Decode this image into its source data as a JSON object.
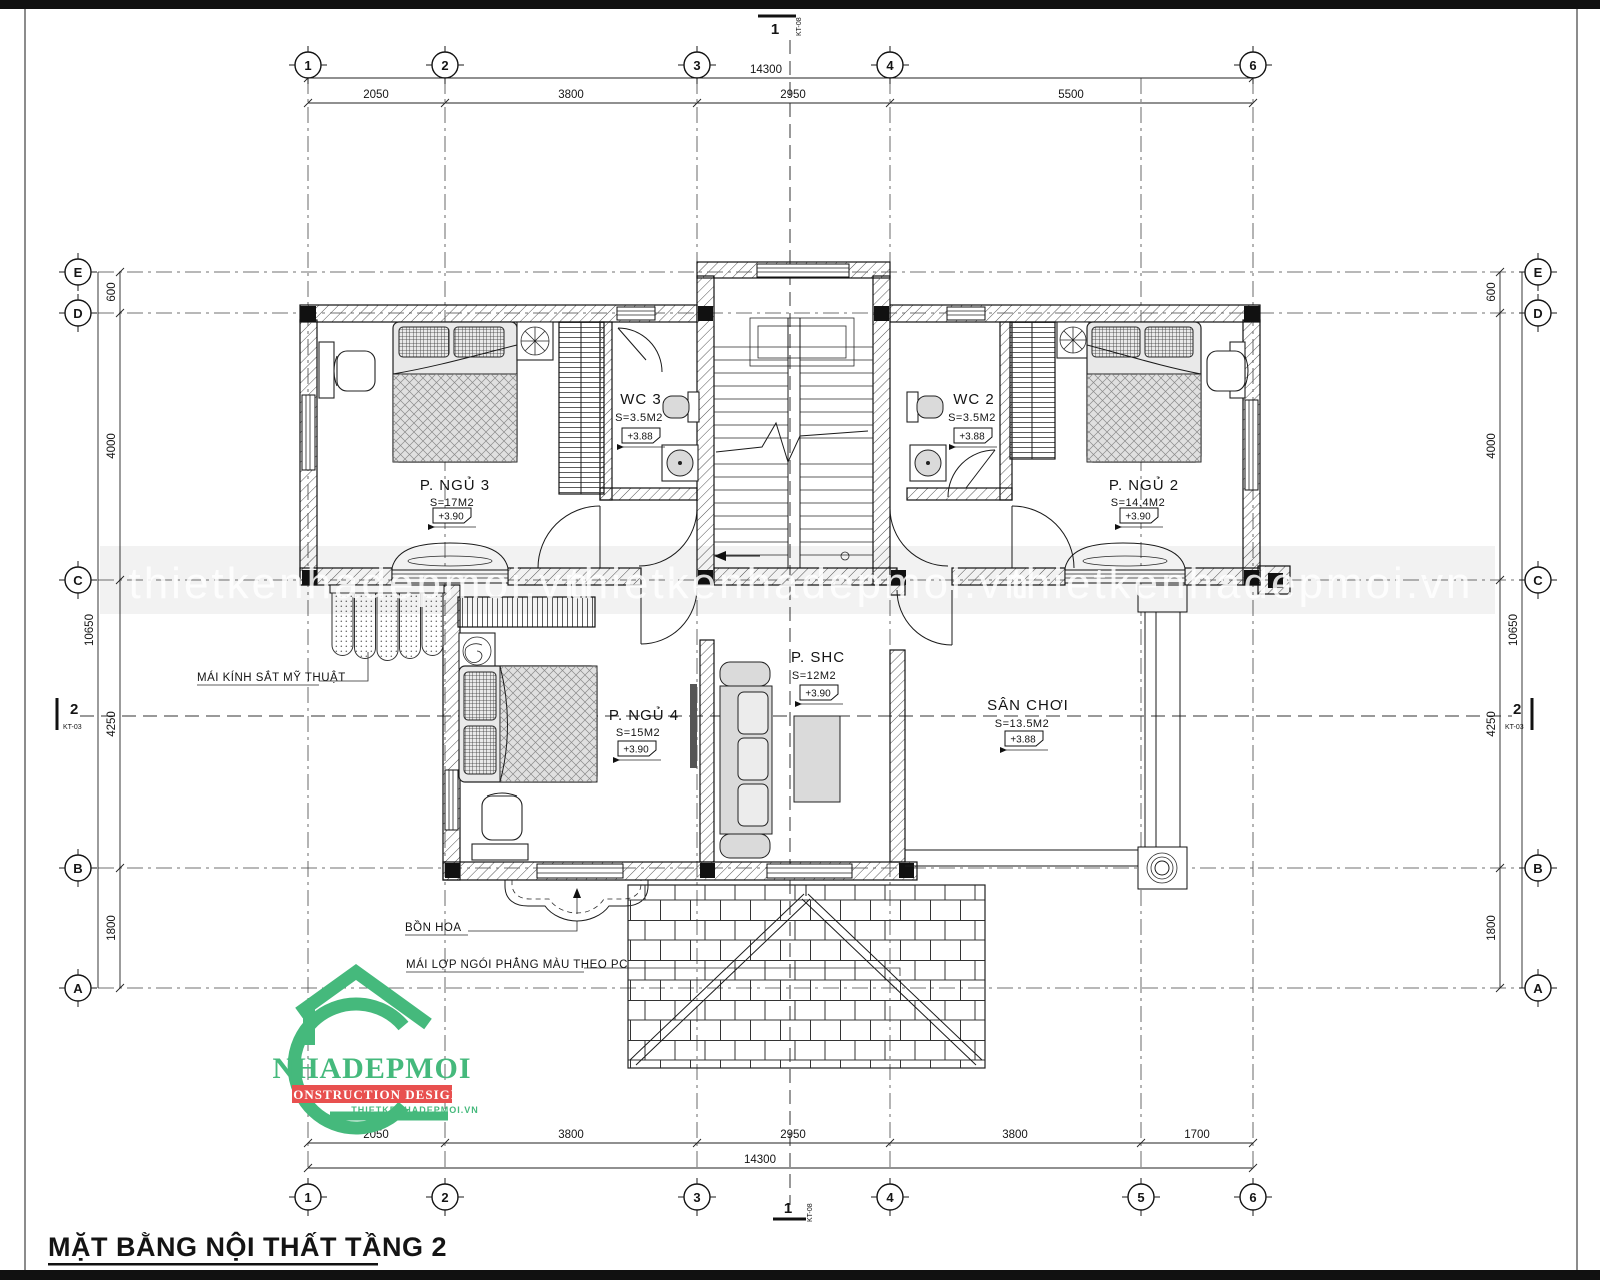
{
  "title": "MẶT BẰNG NỘI THẤT TẦNG 2",
  "watermark": "thietkenhadepmoi.vn",
  "logo": {
    "name": "NHADEPMOI",
    "tagline": "CONSTRUCTION DESIGN",
    "website": "THIETKENHADEPMOI.VN",
    "green": "#45b97c",
    "red": "#e8504f"
  },
  "grid": {
    "cols_top": [
      "1",
      "2",
      "3",
      "4",
      "6"
    ],
    "cols_bottom": [
      "1",
      "2",
      "3",
      "4",
      "5",
      "6"
    ],
    "rows": [
      "E",
      "D",
      "C",
      "B",
      "A"
    ]
  },
  "dims": {
    "top": {
      "total": "14300",
      "segments": [
        "2050",
        "3800",
        "2950",
        "5500"
      ]
    },
    "bottom": {
      "total": "14300",
      "segments": [
        "2050",
        "3800",
        "2950",
        "3800",
        "1700"
      ]
    },
    "side": {
      "total": "10650",
      "segments": [
        "600",
        "4000",
        "4250",
        "1800"
      ]
    }
  },
  "sections": {
    "s1": {
      "no": "1",
      "sheet": "KT-08"
    },
    "s2": {
      "no": "2",
      "sheet": "KT-03"
    }
  },
  "rooms": [
    {
      "name": "P. NGỦ 3",
      "area": "S=17M2",
      "level": "+3.90"
    },
    {
      "name": "WC 3",
      "area": "S=3.5M2",
      "level": "+3.88"
    },
    {
      "name": "WC 2",
      "area": "S=3.5M2",
      "level": "+3.88"
    },
    {
      "name": "P. NGỦ 2",
      "area": "S=14.4M2",
      "level": "+3.90"
    },
    {
      "name": "P. NGỦ 4",
      "area": "S=15M2",
      "level": "+3.90"
    },
    {
      "name": "P. SHC",
      "area": "S=12M2",
      "level": "+3.90"
    },
    {
      "name": "SÂN CHƠI",
      "area": "S=13.5M2",
      "level": "+3.88"
    }
  ],
  "annotations": {
    "canopy": "MÁI KÍNH SẮT MỸ THUẬT",
    "planter": "BỒN HOA",
    "roof": "MÁI LỢP NGÓI PHẲNG MÀU THEO PC"
  }
}
